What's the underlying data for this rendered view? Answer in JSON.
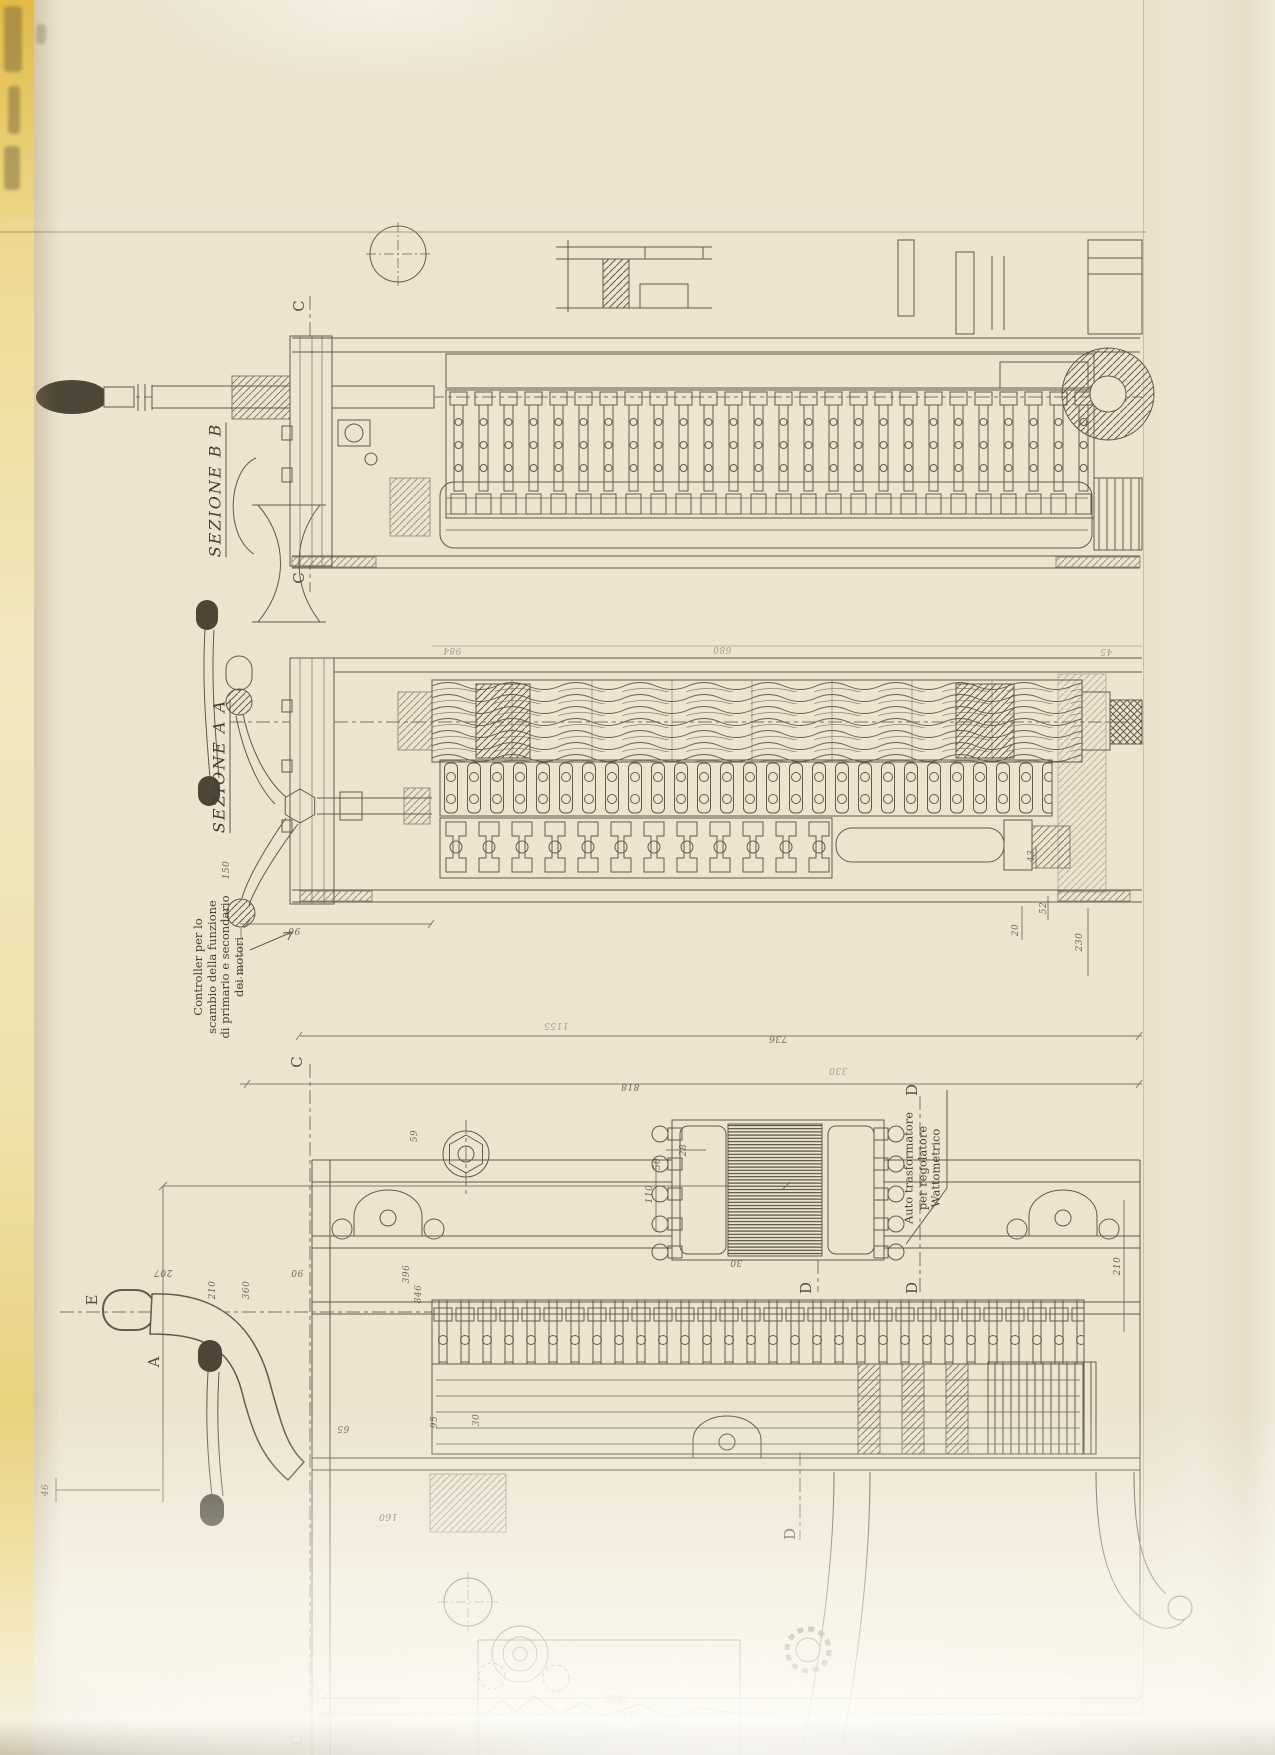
{
  "page": {
    "description": "Scanned fold-out engineering drawing (Italian tramway controller), drawing rotated 90 degrees on portrait page",
    "language": "it"
  },
  "colors": {
    "paper": "#ece4cf",
    "page_edge_yellow": "#e6c455",
    "ink": "#554e3f"
  },
  "labels": {
    "sezione_bb": "SEZIONE B B",
    "sezione_aa": "SEZIONE A A",
    "controller_note": {
      "l1": "Controller per lo",
      "l2": "scambio della funzione",
      "l3": "di primario e secondario",
      "l4": "dei motori"
    },
    "auto_note": {
      "l1": "Auto trasformatore",
      "l2": "per regolatore",
      "l3": "Wattometrico"
    }
  },
  "section_letters": [
    {
      "t": "C",
      "x": 299,
      "y": 306
    },
    {
      "t": "C",
      "x": 299,
      "y": 578
    },
    {
      "t": "C",
      "x": 297,
      "y": 1062
    },
    {
      "t": "C",
      "x": 297,
      "y": 1740
    },
    {
      "t": "D",
      "x": 912,
      "y": 1090
    },
    {
      "t": "D",
      "x": 912,
      "y": 1288
    },
    {
      "t": "D",
      "x": 806,
      "y": 1288
    },
    {
      "t": "D",
      "x": 790,
      "y": 1534
    },
    {
      "t": "E",
      "x": 92,
      "y": 1300
    },
    {
      "t": "A",
      "x": 154,
      "y": 1362
    }
  ],
  "dimension_labels": [
    {
      "t": "150",
      "x": 227,
      "y": 870,
      "r": -90
    },
    {
      "t": "96",
      "x": 294,
      "y": 930,
      "r": 180
    },
    {
      "t": "736",
      "x": 778,
      "y": 1038,
      "r": 180
    },
    {
      "t": "818",
      "x": 630,
      "y": 1086,
      "r": 180
    },
    {
      "t": "1155",
      "x": 556,
      "y": 1025,
      "r": 180,
      "faint": true
    },
    {
      "t": "330",
      "x": 838,
      "y": 1070,
      "r": 180,
      "faint": true
    },
    {
      "t": "984",
      "x": 452,
      "y": 650,
      "r": 180,
      "faint": true
    },
    {
      "t": "680",
      "x": 722,
      "y": 649,
      "r": 180,
      "faint": true
    },
    {
      "t": "45",
      "x": 1106,
      "y": 651,
      "r": 180,
      "faint": true
    },
    {
      "t": "43",
      "x": 1032,
      "y": 856,
      "r": -90
    },
    {
      "t": "20",
      "x": 1016,
      "y": 930,
      "r": -90
    },
    {
      "t": "52",
      "x": 1044,
      "y": 908,
      "r": -90
    },
    {
      "t": "230",
      "x": 1080,
      "y": 942,
      "r": -90
    },
    {
      "t": "110",
      "x": 650,
      "y": 1194,
      "r": -90
    },
    {
      "t": "50",
      "x": 658,
      "y": 1164,
      "r": -90
    },
    {
      "t": "28",
      "x": 684,
      "y": 1150,
      "r": -90
    },
    {
      "t": "30",
      "x": 736,
      "y": 1262,
      "r": 180
    },
    {
      "t": "210",
      "x": 1118,
      "y": 1266,
      "r": -90
    },
    {
      "t": "207",
      "x": 163,
      "y": 1272,
      "r": 180
    },
    {
      "t": "90",
      "x": 297,
      "y": 1272,
      "r": 180
    },
    {
      "t": "360",
      "x": 247,
      "y": 1290,
      "r": -90
    },
    {
      "t": "210",
      "x": 213,
      "y": 1290,
      "r": -90
    },
    {
      "t": "846",
      "x": 419,
      "y": 1294,
      "r": -90
    },
    {
      "t": "396",
      "x": 407,
      "y": 1274,
      "r": -90
    },
    {
      "t": "59",
      "x": 415,
      "y": 1136,
      "r": -90
    },
    {
      "t": "46",
      "x": 46,
      "y": 1490,
      "r": -90
    },
    {
      "t": "65",
      "x": 343,
      "y": 1428,
      "r": 180
    },
    {
      "t": "95",
      "x": 435,
      "y": 1422,
      "r": -90
    },
    {
      "t": "30",
      "x": 477,
      "y": 1420,
      "r": -90
    },
    {
      "t": "160",
      "x": 388,
      "y": 1516,
      "r": 180
    },
    {
      "t": "1020",
      "x": 616,
      "y": 1697,
      "r": 180
    },
    {
      "t": "1245",
      "x": 628,
      "y": 1713,
      "r": 180
    }
  ]
}
